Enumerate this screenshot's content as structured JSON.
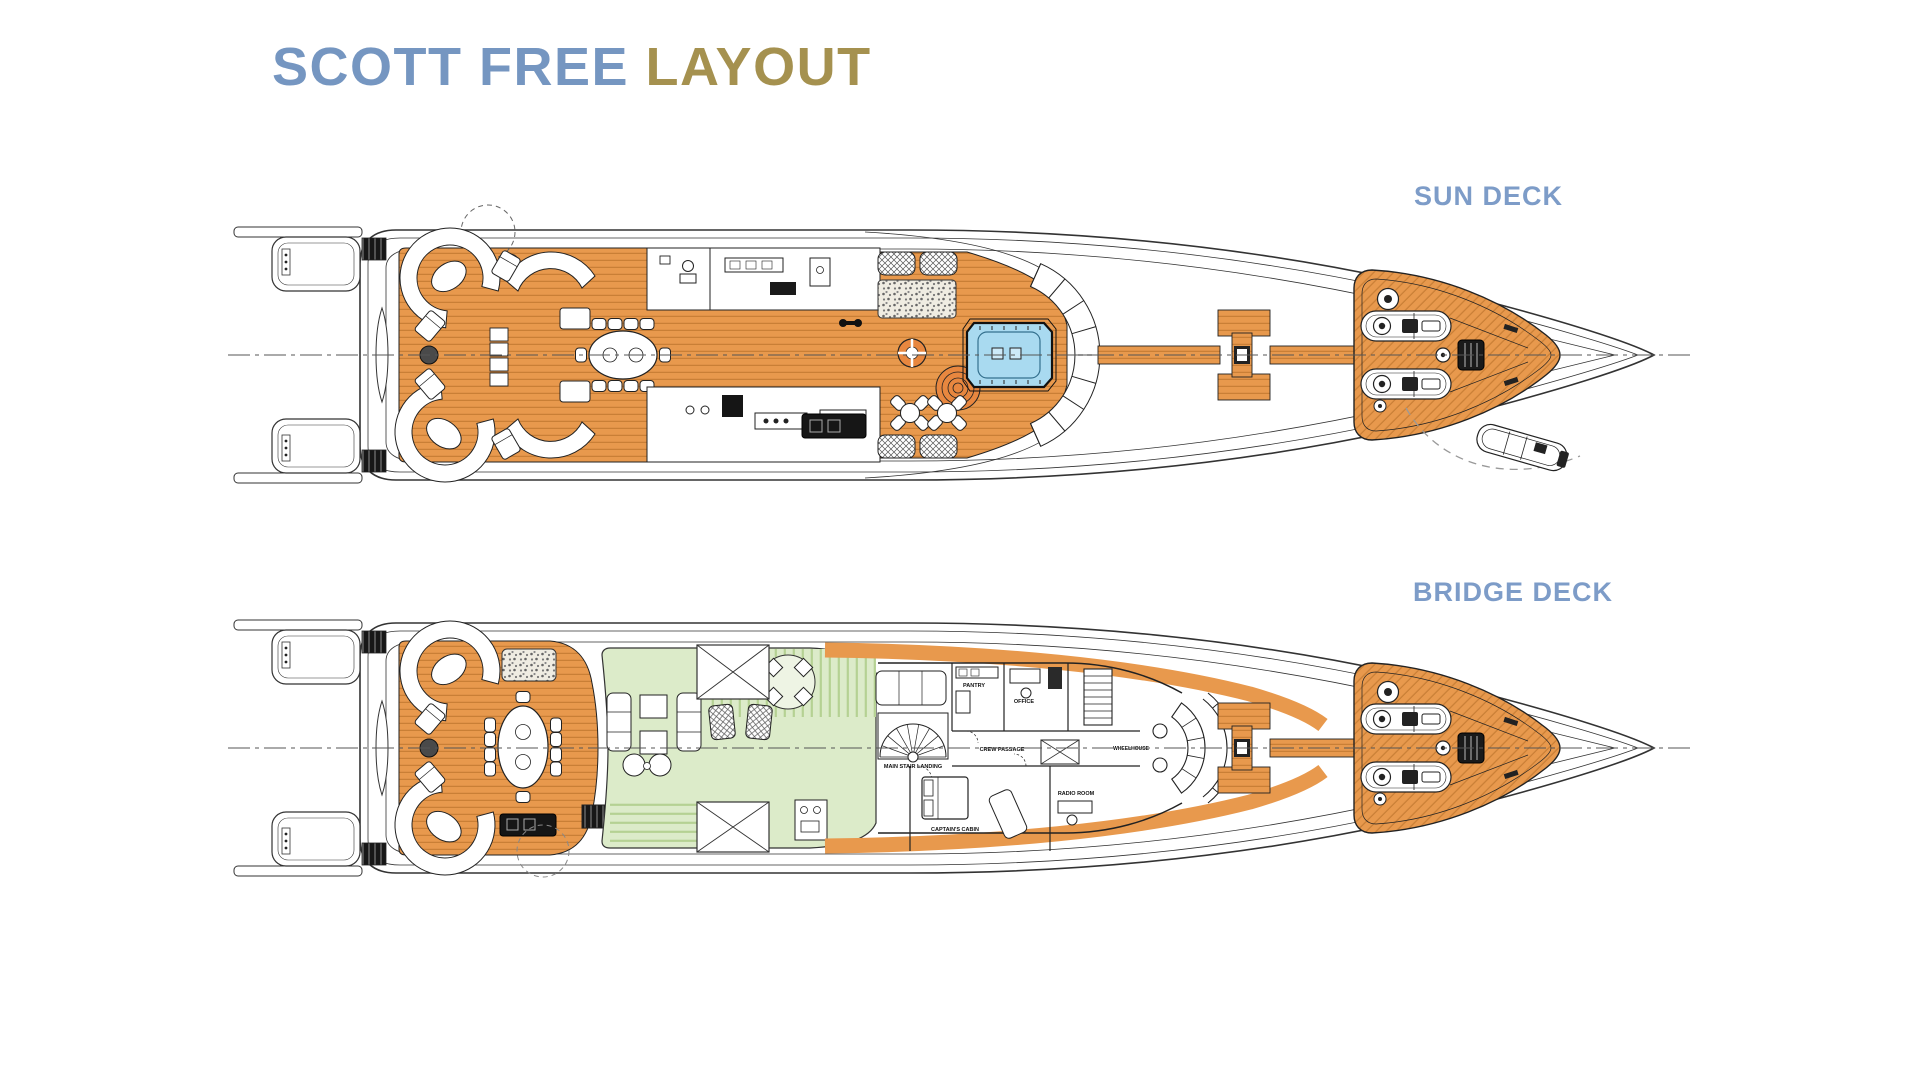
{
  "title": {
    "primary": "SCOTT FREE",
    "secondary": "LAYOUT"
  },
  "decks": {
    "sun": {
      "label": "SUN DECK"
    },
    "bridge": {
      "label": "BRIDGE DECK",
      "rooms": {
        "main_stair_landing": "MAIN STAIR LANDING",
        "crew_passage": "CREW PASSAGE",
        "captains_cabin": "CAPTAIN'S CABIN",
        "pantry": "PANTRY",
        "office": "OFFICE",
        "radio_room": "RADIO ROOM",
        "wheelhouse": "WHEELHOUSE"
      }
    }
  },
  "colors": {
    "title_primary": "#7596c1",
    "title_secondary": "#a5914f",
    "deck_label": "#7d9cc8",
    "teak": "#e8994d",
    "teak_line": "#c97f36",
    "interior_green": "#dcebc9",
    "green_stripe": "#b5d193",
    "pool": "#a9daf0",
    "outline": "#2b2b2b"
  }
}
